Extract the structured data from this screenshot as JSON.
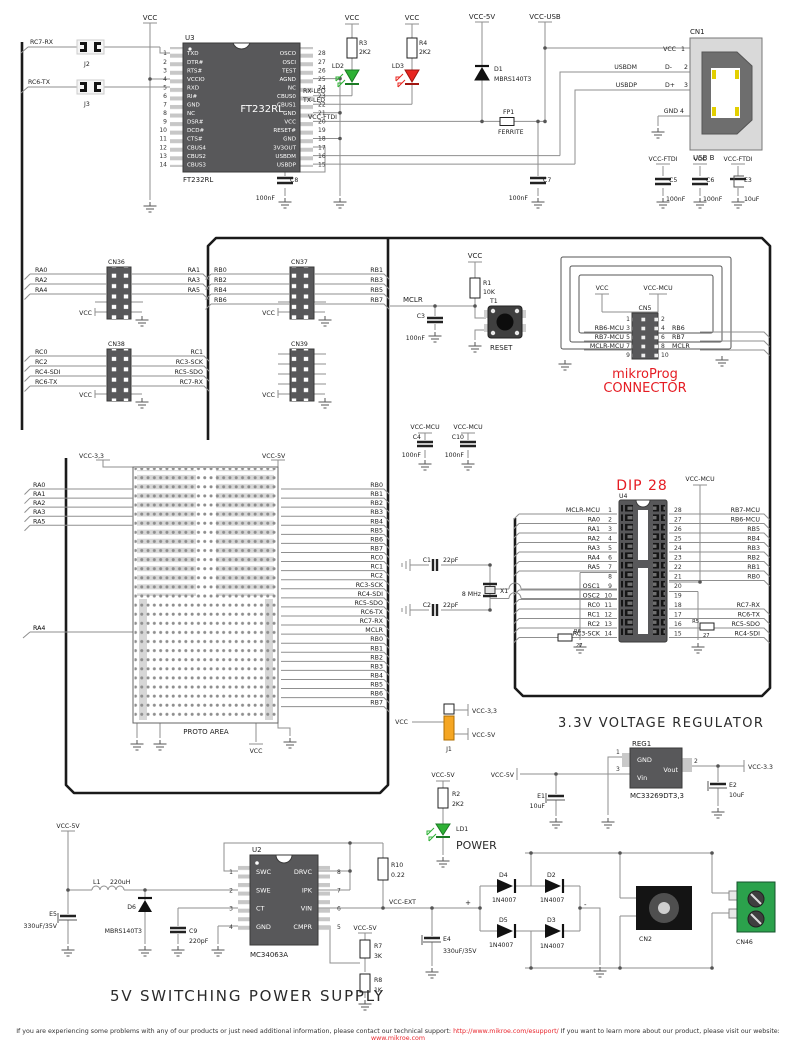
{
  "colors": {
    "accent_red": "#e51c23",
    "led_green": "#2eb135",
    "led_red": "#e8251f",
    "jumper_orange": "#f5a623",
    "terminal_green": "#2ba24c"
  },
  "power": {
    "vcc": "VCC",
    "vcc5": "VCC-5V",
    "vccusb": "VCC-USB",
    "vccftdi": "VCC-FTDI",
    "vccmcu": "VCC-MCU",
    "vcc33": "VCC-3.3",
    "vcc33c": "VCC-3,3",
    "vccext": "VCC-EXT"
  },
  "u3": {
    "ref": "U3",
    "part": "FT232RL",
    "big": "FT232RL",
    "left": [
      "TXD",
      "DTR#",
      "RTS#",
      "VCCIO",
      "RXD",
      "RI#",
      "GND",
      "NC",
      "DSR#",
      "DCD#",
      "CTS#",
      "CBUS4",
      "CBUS2",
      "CBUS3"
    ],
    "left_nums": [
      "1",
      "2",
      "3",
      "4",
      "5",
      "6",
      "7",
      "8",
      "9",
      "10",
      "11",
      "12",
      "13",
      "14"
    ],
    "right": [
      "OSCO",
      "OSCI",
      "TEST",
      "AGND",
      "NC",
      "CBUS0",
      "CBUS1",
      "GND",
      "VCC",
      "RESET#",
      "GND",
      "3V3OUT",
      "USBDM",
      "USBDP"
    ],
    "right_nums": [
      "28",
      "27",
      "26",
      "25",
      "24",
      "23",
      "22",
      "21",
      "20",
      "19",
      "18",
      "17",
      "16",
      "15"
    ]
  },
  "top": {
    "j2": "J2",
    "j3": "J3",
    "rc7rx": "RC7-RX",
    "rc6tx": "RC6-TX",
    "r3": "R3",
    "r3v": "2K2",
    "r4": "R4",
    "r4v": "2K2",
    "ld2": "LD2",
    "ld3": "LD3",
    "rxled": "RX-LED",
    "txled": "TX-LED",
    "d1": "D1",
    "d1p": "MBRS140T3",
    "fp1": "FP1",
    "fp1p": "FERRITE",
    "c8": "C8",
    "c8v": "100nF",
    "c7": "C7",
    "c7v": "100nF"
  },
  "cn1": {
    "ref": "CN1",
    "type": "USB B",
    "p1": "VCC",
    "n1": "1",
    "usbdm": "USBDM",
    "p2": "D-",
    "n2": "2",
    "usbdp": "USBDP",
    "p3": "D+",
    "n3": "3",
    "p4": "GND",
    "n4": "4"
  },
  "caps": {
    "c5": "C5",
    "c5v": "100nF",
    "c6": "C6",
    "c6v": "100nF",
    "e3": "E3",
    "e3v": "10uF",
    "c4": "C4",
    "c4v": "100nF",
    "c10": "C10",
    "c10v": "100nF",
    "c3": "C3",
    "c3v": "100nF",
    "c1": "C1",
    "c1v": "22pF",
    "c2": "C2",
    "c2v": "22pF"
  },
  "headers": {
    "cn36": "CN36",
    "cn37": "CN37",
    "cn38": "CN38",
    "cn39": "CN39",
    "cn36_l": [
      "RA0",
      "RA2",
      "RA4"
    ],
    "cn36_r": [
      "RA1",
      "RA3",
      "RA5"
    ],
    "cn37_l": [
      "RB0",
      "RB2",
      "RB4",
      "RB6"
    ],
    "cn37_r": [
      "RB1",
      "RB3",
      "RB5",
      "RB7"
    ],
    "cn38_l": [
      "RC0",
      "RC2",
      "RC4-SDI",
      "RC6-TX"
    ],
    "cn38_r": [
      "RC1",
      "RC3-SCK",
      "RC5-SDO",
      "RC7-RX"
    ]
  },
  "reset": {
    "r1": "R1",
    "r1v": "10K",
    "t1": "T1",
    "btn": "RESET",
    "mclr": "MCLR"
  },
  "mp": {
    "cn": "CN5",
    "t1": "mikroProg",
    "t2": "CONNECTOR",
    "l": [
      "RB6-MCU",
      "RB7-MCU",
      "MCLR-MCU"
    ],
    "r": [
      "RB6",
      "RB7",
      "MCLR"
    ],
    "nl": [
      "1",
      "3",
      "5",
      "7",
      "9"
    ],
    "nr": [
      "2",
      "4",
      "6",
      "8",
      "10"
    ]
  },
  "dip": {
    "title": "DIP 28",
    "ref": "U4",
    "ln": [
      "1",
      "2",
      "3",
      "4",
      "5",
      "6",
      "7",
      "8",
      "9",
      "10",
      "11",
      "12",
      "13",
      "14"
    ],
    "rn": [
      "28",
      "27",
      "26",
      "25",
      "24",
      "23",
      "22",
      "21",
      "20",
      "19",
      "18",
      "17",
      "16",
      "15"
    ],
    "l": [
      "MCLR-MCU",
      "RA0",
      "RA1",
      "RA2",
      "RA3",
      "RA4",
      "RA5",
      "",
      "OSC1",
      "OSC2",
      "RC0",
      "RC1",
      "RC2",
      "RC3-SCK"
    ],
    "r": [
      "RB7-MCU",
      "RB6-MCU",
      "RB5",
      "RB4",
      "RB3",
      "RB2",
      "RB1",
      "RB0",
      "",
      "",
      "RC7-RX",
      "RC6-TX",
      "RC5-SDO",
      "RC4-SDI"
    ],
    "r5": "R5",
    "r5v": "27",
    "r6": "R6",
    "r6v": "27"
  },
  "xtal": {
    "x1": "X1",
    "f": "8 MHz"
  },
  "proto": {
    "label": "PROTO AREA",
    "l": [
      "RA0",
      "RA1",
      "RA2",
      "RA3",
      "RA5"
    ],
    "ra4": "RA4",
    "r": [
      "RB0",
      "RB1",
      "RB2",
      "RB3",
      "RB4",
      "RB5",
      "RB6",
      "RB7",
      "RC0",
      "RC1",
      "RC2",
      "RC3-SCK",
      "RC4-SDI",
      "RC5-SDO",
      "RC6-TX",
      "RC7-RX",
      "MCLR",
      "RB0",
      "RB1",
      "RB2",
      "RB3",
      "RB4",
      "RB5",
      "RB6",
      "RB7"
    ]
  },
  "j1": {
    "ref": "J1"
  },
  "reg": {
    "title": "3.3V  VOLTAGE  REGULATOR",
    "ref": "REG1",
    "part": "MC33269DT3,3",
    "gnd": "GND",
    "vin": "Vin",
    "vout": "Vout",
    "n1": "1",
    "n2": "2",
    "n3": "3",
    "e1": "E1",
    "e1v": "10uF",
    "e2": "E2",
    "e2v": "10uF"
  },
  "pwrled": {
    "r2": "R2",
    "r2v": "2K2",
    "ld1": "LD1",
    "label": "POWER"
  },
  "psu": {
    "title": "5V  SWITCHING  POWER  SUPPLY",
    "u2": "U2",
    "part": "MC34063A",
    "l": [
      "SWC",
      "SWE",
      "CT",
      "GND"
    ],
    "ln": [
      "1",
      "2",
      "3",
      "4"
    ],
    "r": [
      "DRVC",
      "IPK",
      "VIN",
      "CMPR"
    ],
    "rn": [
      "8",
      "7",
      "6",
      "5"
    ],
    "l1": "L1",
    "l1v": "220uH",
    "d6": "D6",
    "d6p": "MBRS140T3",
    "e5": "E5",
    "e5v": "330uF/35V",
    "c9": "C9",
    "c9v": "220pF",
    "r10": "R10",
    "r10v": "0.22",
    "r7": "R7",
    "r7v": "3K",
    "r8": "R8",
    "r8v": "1K",
    "e4": "E4",
    "e4v": "330uF/35V",
    "plus": "+",
    "minus": "-",
    "d4": "D4",
    "d4p": "1N4007",
    "d2": "D2",
    "d2p": "1N4007",
    "d5": "D5",
    "d5p": "1N4007",
    "d3": "D3",
    "d3p": "1N4007",
    "cn2": "CN2",
    "cn46": "CN46"
  },
  "footer": {
    "t1": "If you are experiencing some problems with any of our products or just need additional information, please contact our technical support: ",
    "l1": "http://www.mikroe.com/esupport/",
    "t2": "   If you want to learn more about our product, please visit our website: ",
    "l2": "www.mikroe.com"
  }
}
